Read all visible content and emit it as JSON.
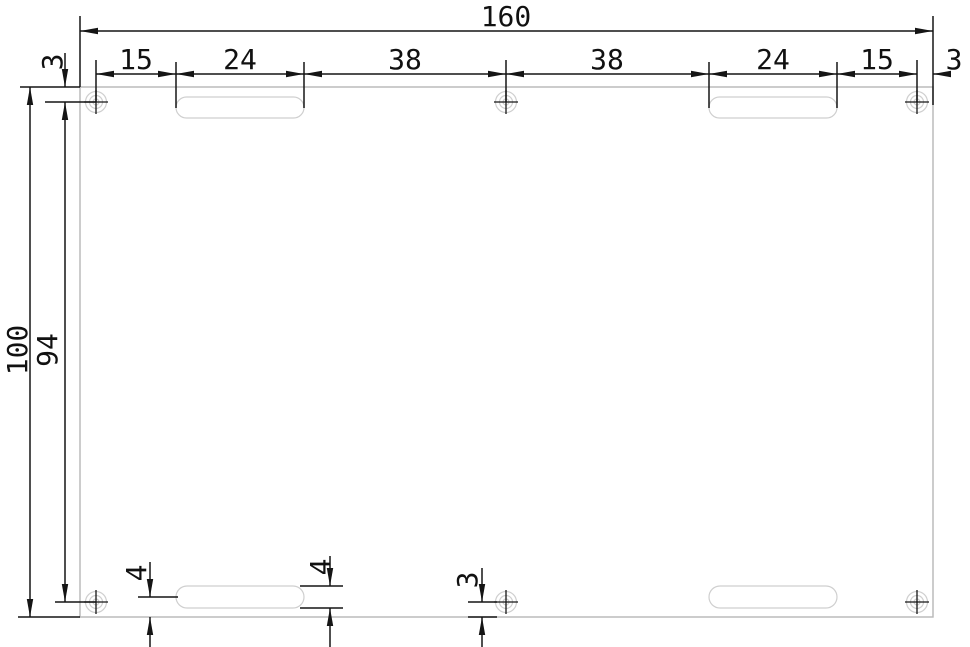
{
  "drawing": {
    "kind": "technical-drawing-plate",
    "dimensions": {
      "overall_width": "160",
      "overall_height": "100",
      "hole_row_span": "94",
      "top_edge_to_hole": "3",
      "top_chain": [
        "15",
        "24",
        "38",
        "38",
        "24",
        "15",
        "3"
      ],
      "bottom_slot_center_to_edge": "4",
      "bottom_slot_height": "4",
      "bottom_hole_to_edge": "3"
    },
    "features": {
      "holes": 6,
      "slots": 4
    },
    "colors": {
      "background": "#ffffff",
      "dimension_lines": "#151515",
      "plate_outline": "#b7b7b7",
      "feature_outline": "#cfcfcf"
    }
  }
}
